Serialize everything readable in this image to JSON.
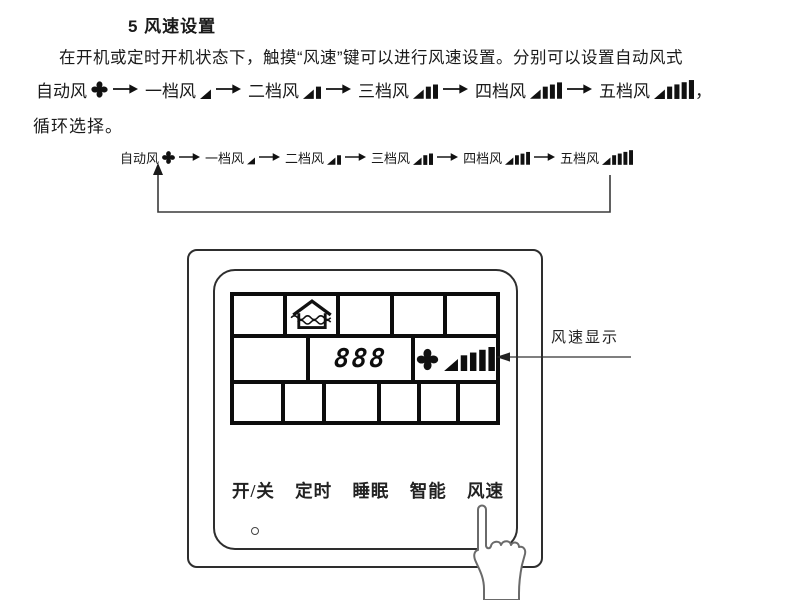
{
  "document": {
    "heading": "5 风速设置",
    "intro_line": "在开机或定时开机状态下，触摸“风速”键可以进行风速设置。分别可以设置自动风式",
    "outro_line": "循环选择。",
    "trailing_comma": "，"
  },
  "speed_sequence": {
    "items": [
      {
        "label": "自动风",
        "icon": "fan-icon"
      },
      {
        "label": "一档风",
        "icon": "fan-speed-1-icon"
      },
      {
        "label": "二档风",
        "icon": "fan-speed-2-icon"
      },
      {
        "label": "三档风",
        "icon": "fan-speed-3-icon"
      },
      {
        "label": "四档风",
        "icon": "fan-speed-4-icon"
      },
      {
        "label": "五档风",
        "icon": "fan-speed-5-icon"
      }
    ]
  },
  "panel": {
    "display": {
      "digits": "888",
      "fan_speed_level": 5
    },
    "buttons": [
      {
        "label": "开/关"
      },
      {
        "label": "定时"
      },
      {
        "label": "睡眠"
      },
      {
        "label": "智能"
      },
      {
        "label": "风速"
      }
    ]
  },
  "callout": {
    "label": "风速显示"
  }
}
